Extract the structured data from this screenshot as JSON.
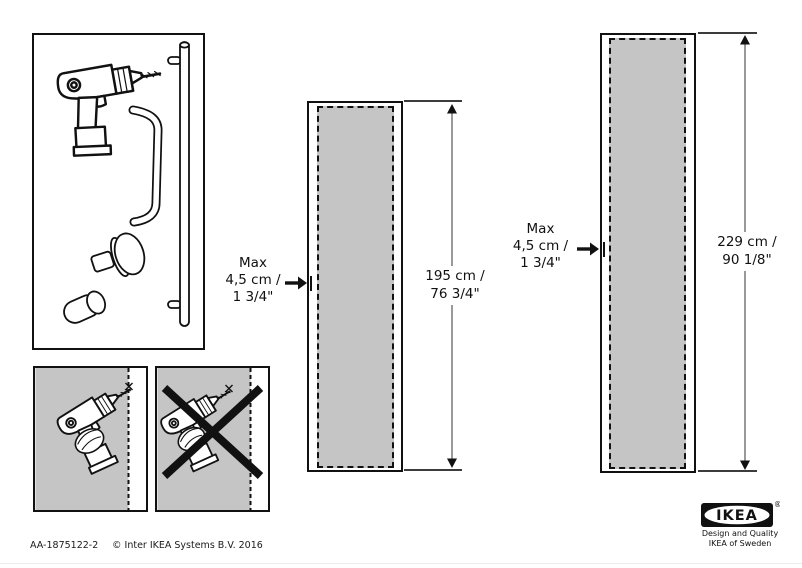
{
  "colors": {
    "zone_gray": "#c5c5c5",
    "stroke": "#111111"
  },
  "parts": {
    "items": [
      "cordless-drill",
      "bar-handle",
      "bow-handle",
      "round-knob",
      "cylinder-knob"
    ]
  },
  "drill_instructions": {
    "allowed": "drill-near-edge-allowed",
    "not_allowed": "drill-away-from-edge-crossed-out"
  },
  "doors": [
    {
      "max_l1": "Max",
      "max_l2": "4,5 cm /",
      "max_l3": "1 3/4\"",
      "size_l1": "195 cm /",
      "size_l2": "76 3/4\""
    },
    {
      "max_l1": "Max",
      "max_l2": "4,5 cm /",
      "max_l3": "1 3/4\"",
      "size_l1": "229 cm /",
      "size_l2": "90 1/8\""
    }
  ],
  "footer": {
    "article": "AA-1875122-2",
    "copyright": "© Inter IKEA Systems B.V. 2016"
  },
  "brand": {
    "logo_text": "IKEA",
    "registered": "®",
    "tagline_l1": "Design and Quality",
    "tagline_l2": "IKEA of Sweden"
  }
}
